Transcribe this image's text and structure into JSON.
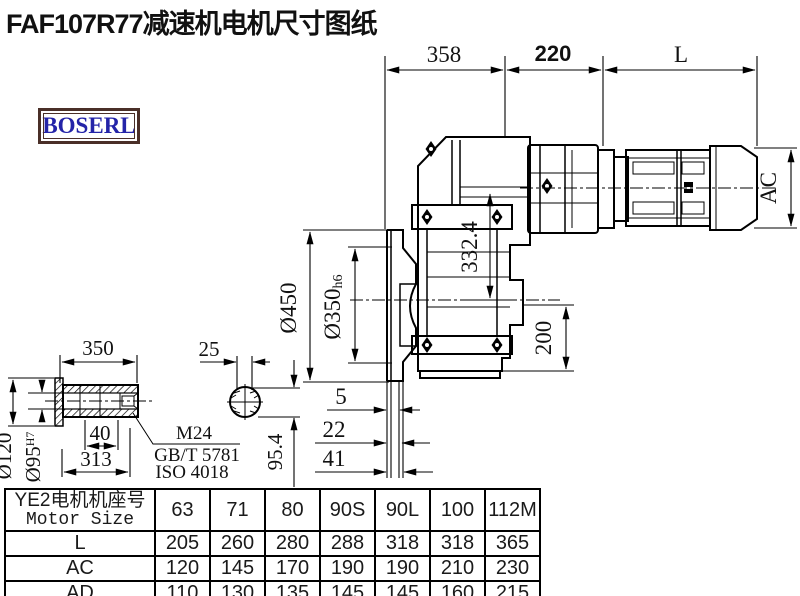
{
  "title": "FAF107R77减速机电机尺寸图纸",
  "logo": {
    "text": "BOSERL",
    "text_color": "#2424a8",
    "frame_color": "#4a2f28"
  },
  "dims": {
    "width_358": "358",
    "width_220": "220",
    "motor_len": "L",
    "motor_dia": "AC",
    "flange_dia": "Ø450",
    "spigot_dia": "Ø350",
    "spigot_tol": "h6",
    "center_dist": "332.4",
    "foot_height": "200",
    "step_5": "5",
    "step_22": "22",
    "step_41": "41"
  },
  "shaft": {
    "length": "350",
    "key_width": "25",
    "outer_dia": "Ø120",
    "bore_dia": "Ø95",
    "bore_tol": "H7",
    "depth_40": "40",
    "length_313": "313",
    "key_height": "95.4",
    "thread": "M24",
    "standard_gb": "GB/T 5781",
    "standard_iso": "ISO 4018"
  },
  "table": {
    "header_cn": "YE2电机机座号",
    "header_en": "Motor Size",
    "columns": [
      "63",
      "71",
      "80",
      "90S",
      "90L",
      "100",
      "112M"
    ],
    "rows": [
      {
        "label": "L",
        "values": [
          "205",
          "260",
          "280",
          "288",
          "318",
          "318",
          "365"
        ]
      },
      {
        "label": "AC",
        "values": [
          "120",
          "145",
          "170",
          "190",
          "190",
          "210",
          "230"
        ]
      },
      {
        "label": "AD",
        "values": [
          "110",
          "130",
          "135",
          "145",
          "145",
          "160",
          "215"
        ]
      }
    ]
  }
}
